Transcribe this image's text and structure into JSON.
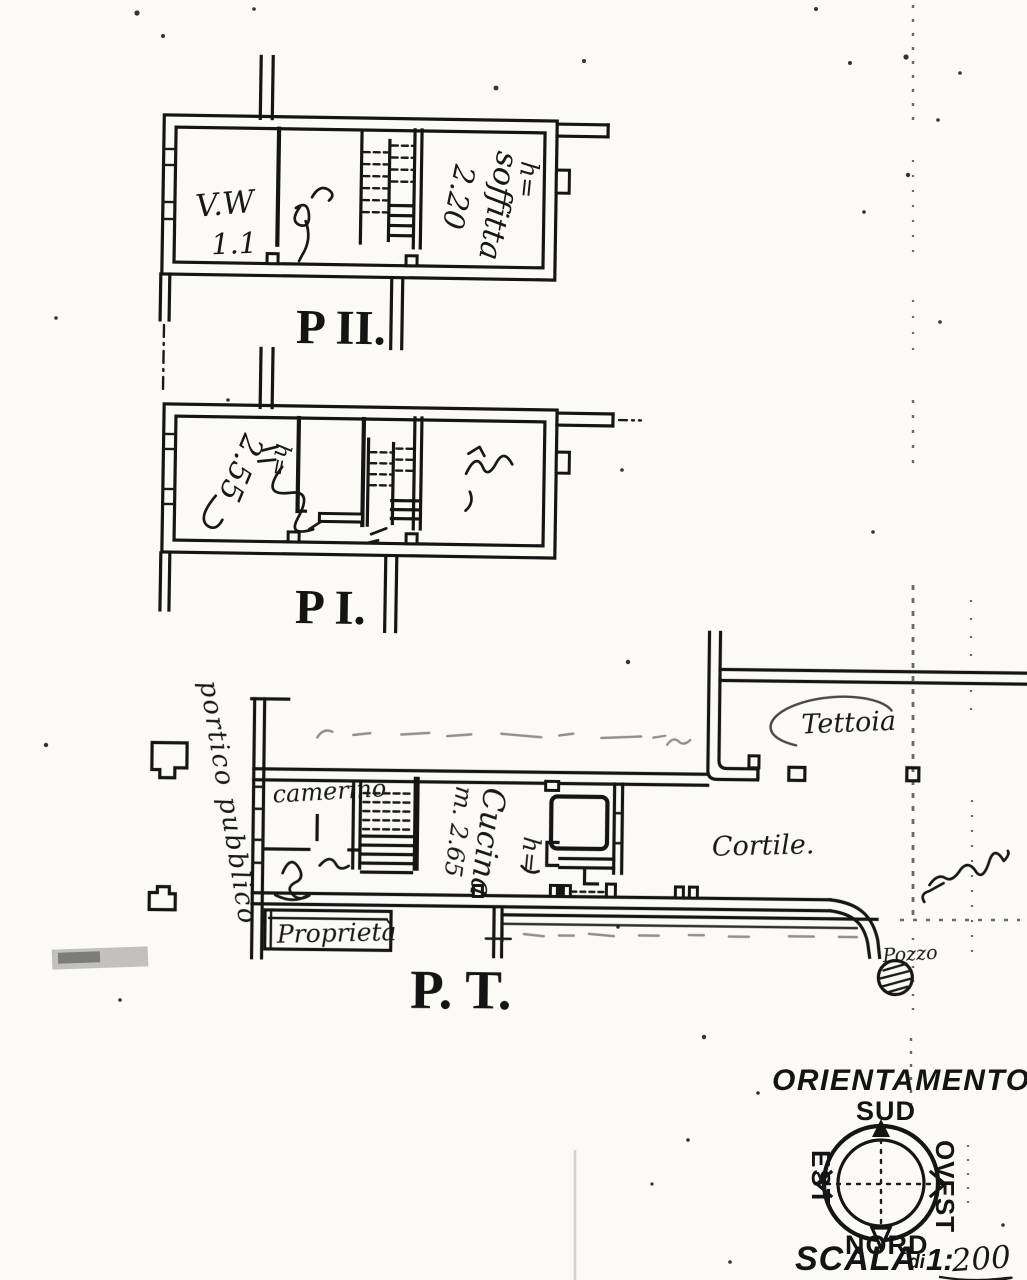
{
  "plan_p2": {
    "label": "P II.",
    "room_left_line1": "V.W",
    "room_left_line2": "1.1",
    "attic_h": "h=",
    "attic_name": "soffitta",
    "attic_height": "2.20"
  },
  "plan_p1": {
    "label": "P I.",
    "height_note": "2.55",
    "h_note": "h="
  },
  "plan_pt": {
    "label": "P. T.",
    "room_camerino": "camerino",
    "kitchen_name": "Cucina",
    "kitchen_width": "m. 2.65",
    "kitchen_h": "h=",
    "tettoia": "Tettoia",
    "cortile": "Cortile.",
    "portico": "portico pubblico",
    "proprieta": "Proprietà",
    "pozzo": "Pozzo"
  },
  "compass": {
    "title": "ORIENTAMENTO",
    "south": "SUD",
    "north": "NORD",
    "east": "EST",
    "west": "OVEST"
  },
  "scale": {
    "word": "SCALA",
    "di": "di",
    "ratio": "1:",
    "value": "200"
  }
}
